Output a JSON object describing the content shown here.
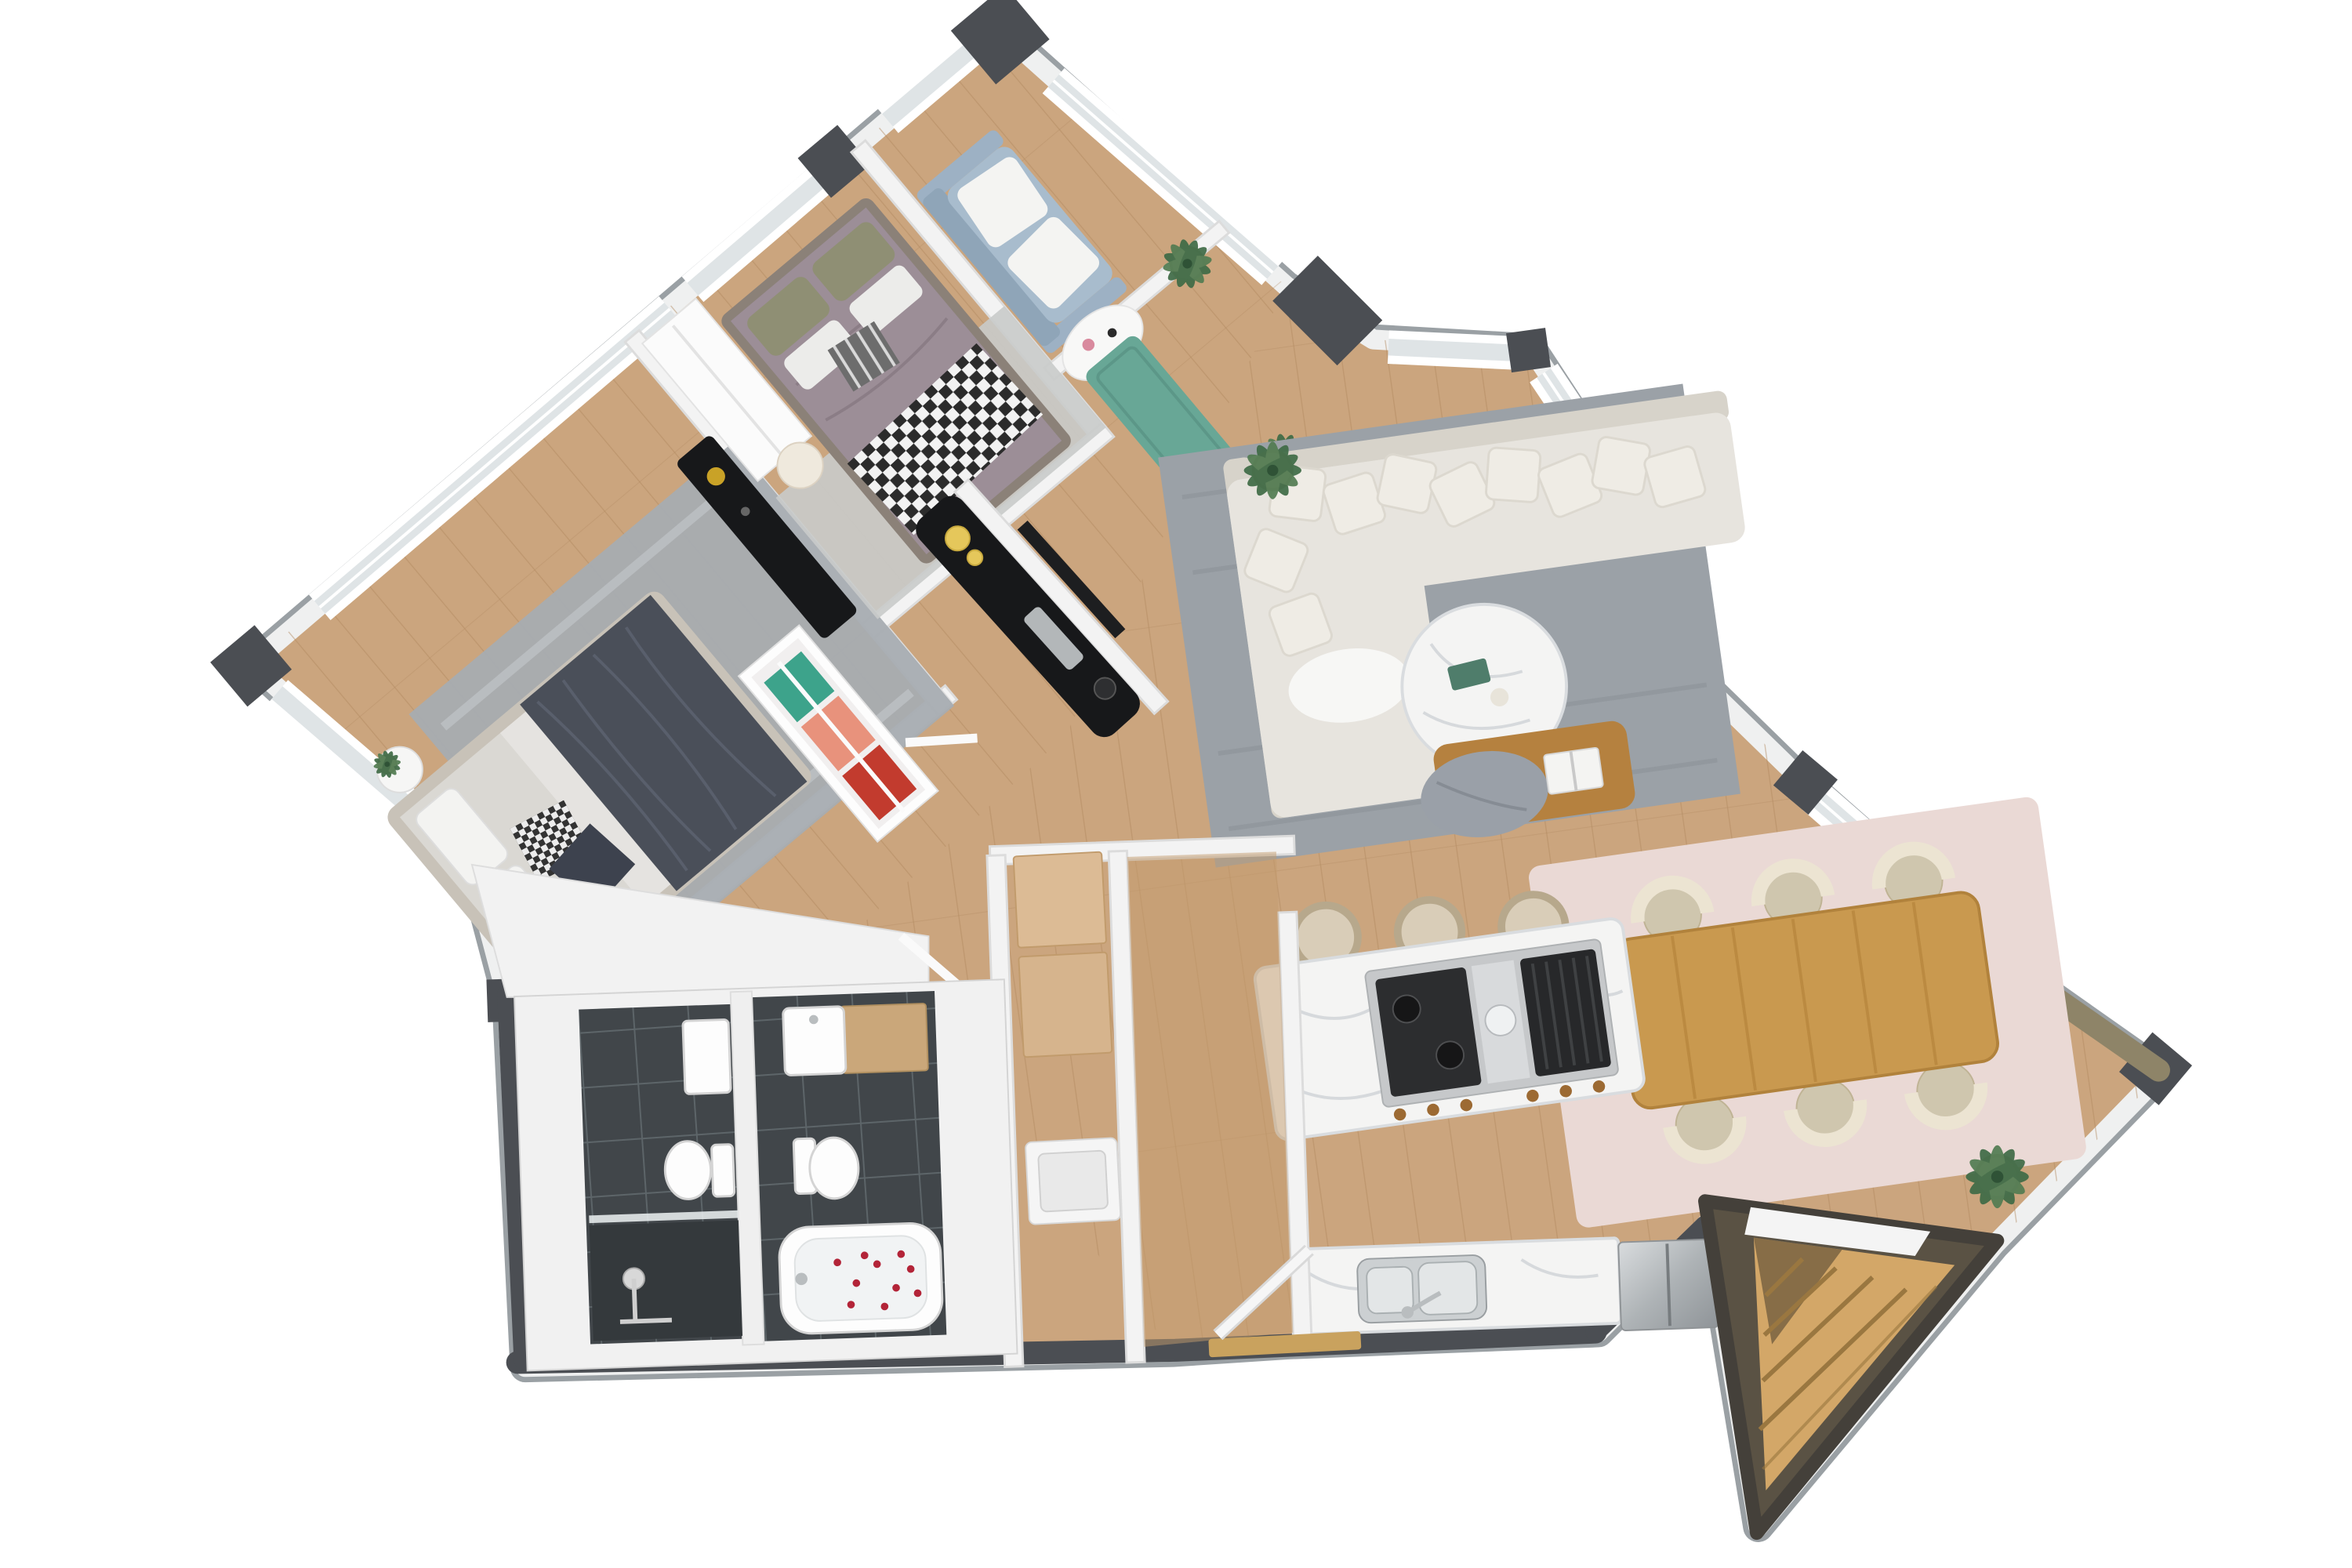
{
  "title": "3D cutaway floor plan render — two-bedroom apartment, top-down view",
  "view": {
    "type": "3d-floorplan-top-down",
    "background": "#ffffff",
    "no_visible_text": true
  },
  "colors": {
    "wall_outer": "#4b4e53",
    "wall_white": "#f3f3f3",
    "wall_stroke": "#dcdcdc",
    "floor_wood": "#cba57e",
    "floor_wood_line": "#b28a5f",
    "floor_entry": "#c49b6e",
    "tile_dark": "#41464a",
    "tile_grout": "#5d6569",
    "rug_gray": "#a7acb1",
    "rug_living": "#9ba1a7",
    "rug_light": "#c9cbca",
    "rug_blush": "#ead9d5",
    "mat_green": "#68a796",
    "sofa_cream": "#e7e4de",
    "sofa_shadow": "#d7d3ca",
    "sofa_blue": "#a8bccd",
    "bed_sheet": "#dad8d3",
    "blanket_dark": "#4a4f59",
    "duvet_mauve": "#9c8e97",
    "pillow_olive": "#8f8f74",
    "marble": "#f4f4f3",
    "marble_vein": "#c9cdd1",
    "wood_table": "#c9994f",
    "wood_stairs": "#d3a768",
    "stairs_wall": "#5a5244",
    "tan_ottoman": "#b5813f",
    "cabinet_tan": "#dcbb95",
    "appliance_steel": "#b9bdc0",
    "console_black": "#17181a",
    "plant_green": "#3f6b46",
    "accent_yellow": "#e5c75b",
    "clothes_green": "#3da38b",
    "clothes_coral": "#e8927c",
    "clothes_red": "#c23b2e",
    "petal_red": "#b32438",
    "glass": "#dfe4e6"
  },
  "rooms": [
    {
      "id": "master-bedroom",
      "label": "Master bedroom",
      "furniture": [
        "double bed with dark gray throw blanket",
        "light gray sheets",
        "houndstooth + charcoal accent pillows",
        "gray area rug",
        "two round white nightstands with plants",
        "black dresser with brass lamp",
        "slim wardrobe closet with hanging clothes (green, coral, red)"
      ]
    },
    {
      "id": "bedroom-2",
      "label": "Second bedroom",
      "furniture": [
        "double bed with mauve duvet",
        "black & white gingham throw",
        "olive green pillows",
        "striped accent pillow",
        "cream scalloped nightstand",
        "white wardrobe",
        "light gray rug"
      ]
    },
    {
      "id": "den",
      "label": "Den / study nook",
      "furniture": [
        "light blue loveseat with two white cushions",
        "white demilune side table with flowers and candle"
      ]
    },
    {
      "id": "balcony",
      "label": "Balcony strip",
      "furniture": [
        "teal-green runner mat",
        "two potted palms"
      ]
    },
    {
      "id": "living-room",
      "label": "Living room",
      "furniture": [
        "cream L-shaped sectional sofa with many scatter pillows",
        "white throw",
        "gray textured area rug",
        "round white marble coffee table with books",
        "tan leather ottoman bench with gray throw and open book",
        "black media console with yellow vases and candle",
        "wall-mounted TV",
        "potted palm",
        "corner bay windows"
      ]
    },
    {
      "id": "dining-room",
      "label": "Dining area",
      "furniture": [
        "rectangular oak dining table",
        "six cream barrel chairs",
        "blush pink area rug",
        "potted palm",
        "full-height picture window"
      ]
    },
    {
      "id": "kitchen",
      "label": "Kitchen",
      "furniture": [
        "white marble island with gas cooktop and grill",
        "three cream counter stools",
        "marble counter with double stainless sink and faucet",
        "stainless steel refrigerator"
      ]
    },
    {
      "id": "utility",
      "label": "Utility / storage closets",
      "furniture": [
        "two tan storage cabinets",
        "white washing machine"
      ]
    },
    {
      "id": "entry",
      "label": "Entry hall",
      "furniture": [
        "open white entry door",
        "wood threshold",
        "diagonal plank flooring"
      ]
    },
    {
      "id": "bathroom-shower",
      "label": "Shower bathroom",
      "furniture": [
        "walk-in shower with dark slate tile",
        "chrome shower set",
        "toilet",
        "white basin unit",
        "glass screen"
      ]
    },
    {
      "id": "bathroom-main",
      "label": "Main bathroom",
      "furniture": [
        "white bathtub with scattered rose petals",
        "toilet",
        "white basin on wood vanity",
        "dark slate tile floor"
      ]
    },
    {
      "id": "stairwell",
      "label": "Triangular stairwell",
      "furniture": [
        "light oak winder stairs",
        "dark bronze walls",
        "white landing"
      ]
    }
  ],
  "counts": {
    "bedrooms": 2,
    "bathrooms": 2,
    "dining_chairs": 6,
    "island_stools": 3,
    "potted_plants": 5,
    "closet_clothes_colors": 3
  }
}
